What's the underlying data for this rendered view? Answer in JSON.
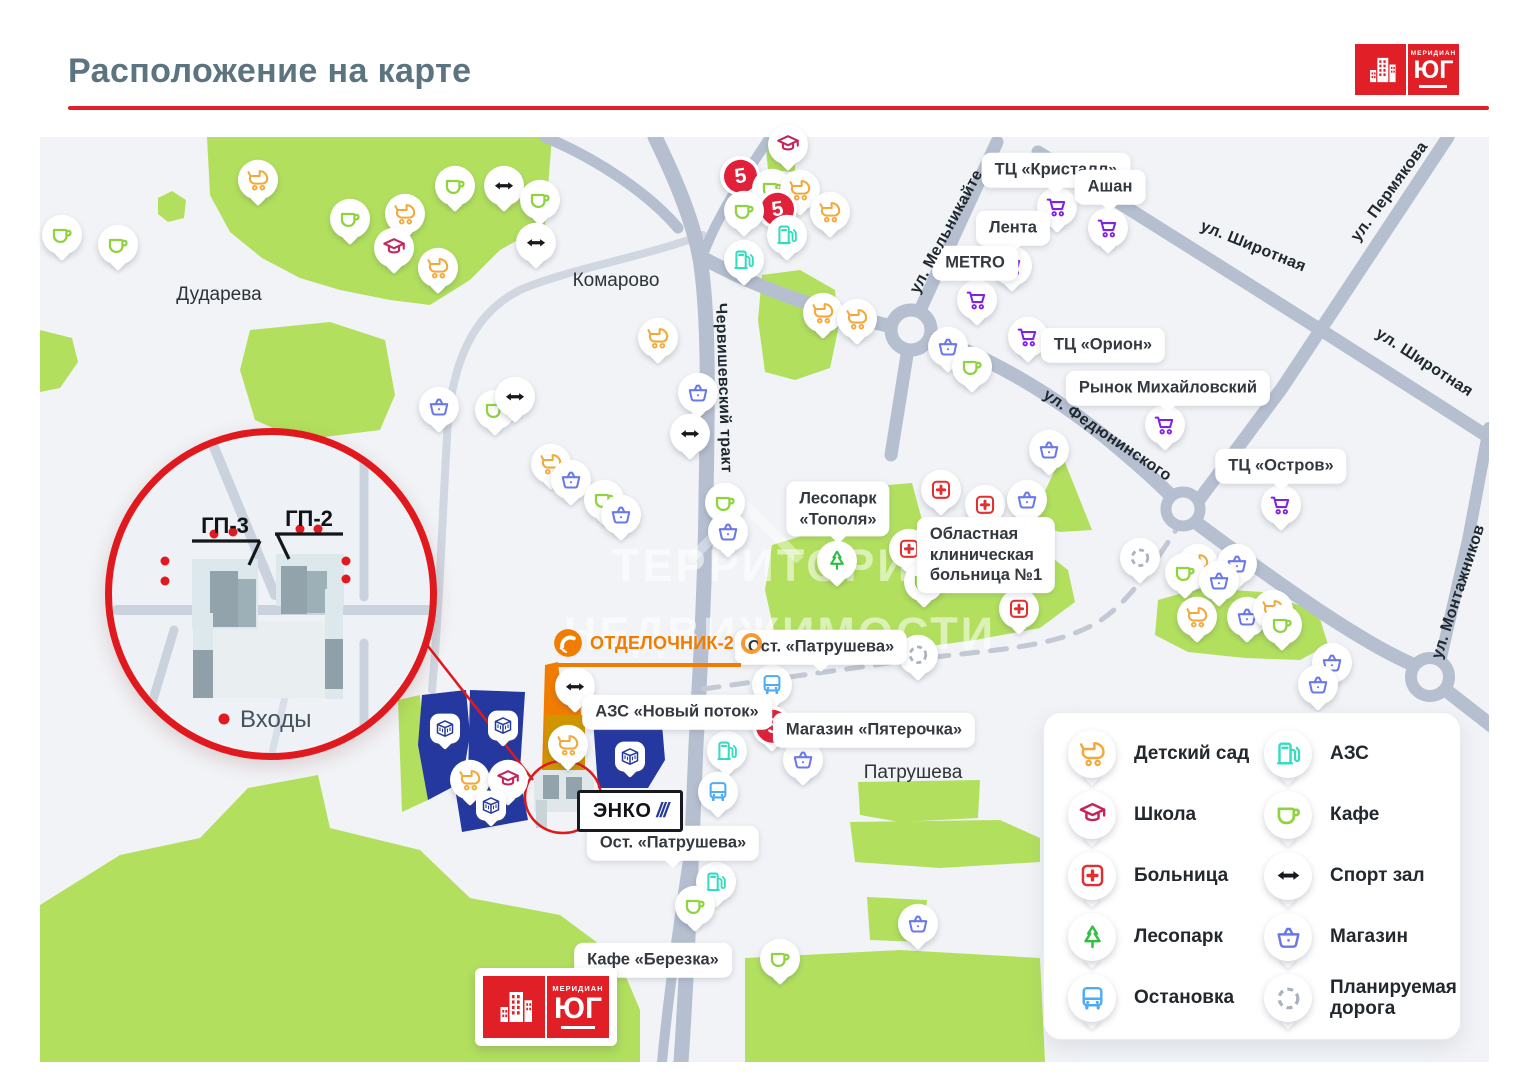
{
  "header": {
    "title": "Расположение на карте",
    "logo": {
      "top": "МЕРИДИАН",
      "main": "ЮГ"
    }
  },
  "watermark": {
    "line1": "ТЕРРИТОРИЯ",
    "line2": "НЕДВИЖИМОСТИ"
  },
  "colors": {
    "accent_red": "#e01f26",
    "map_bg": "#f1f3f6",
    "road": "#b5bfd0",
    "park": "#b2e05e",
    "complex_blue": "#2438a0",
    "otdelochnik_orange": "#f07c00",
    "icons": {
      "stroller": "#f2a93b",
      "school": "#c2255c",
      "hospital": "#e03131",
      "tree": "#2fbf43",
      "bus": "#4dabf7",
      "gas": "#35dcc0",
      "cafe": "#8fd43f",
      "sport": "#17191c",
      "basket": "#6a79e8",
      "cart": "#8123e0",
      "planned": "#a9b2bd",
      "p5": "#e2203a",
      "building": "#2438a0"
    }
  },
  "map": {
    "p5_text": "5",
    "area_labels": [
      {
        "text": "Дударева",
        "x": 219,
        "y": 295
      },
      {
        "text": "Комарово",
        "x": 616,
        "y": 281
      },
      {
        "text": "Патрушева",
        "x": 913,
        "y": 773
      }
    ],
    "street_labels": [
      {
        "text": "Червишевский тракт",
        "x": 723,
        "y": 388,
        "angle": 88
      },
      {
        "text": "ул. Мельникайте",
        "x": 947,
        "y": 232,
        "angle": -62
      },
      {
        "text": "ул. Широтная",
        "x": 1253,
        "y": 247,
        "angle": 22
      },
      {
        "text": "ул. Пермякова",
        "x": 1390,
        "y": 192,
        "angle": -54
      },
      {
        "text": "ул. Широтная",
        "x": 1424,
        "y": 363,
        "angle": 33
      },
      {
        "text": "ул. Федюнинского",
        "x": 1107,
        "y": 436,
        "angle": 34
      },
      {
        "text": "ул. Монтажников",
        "x": 1459,
        "y": 592,
        "angle": -72
      }
    ],
    "place_labels": [
      {
        "lines": [
          "ТЦ «Кристалл»"
        ],
        "x": 1056,
        "y": 170,
        "tail": true
      },
      {
        "lines": [
          "Ашан"
        ],
        "x": 1110,
        "y": 187,
        "tail": true
      },
      {
        "lines": [
          "Лента"
        ],
        "x": 1013,
        "y": 228,
        "tail": true
      },
      {
        "lines": [
          "METRO"
        ],
        "x": 975,
        "y": 263,
        "tail": false
      },
      {
        "lines": [
          "ТЦ «Орион»"
        ],
        "x": 1103,
        "y": 345,
        "tail": false
      },
      {
        "lines": [
          "Рынок Михайловский"
        ],
        "x": 1168,
        "y": 388,
        "tail": true
      },
      {
        "lines": [
          "ТЦ «Остров»"
        ],
        "x": 1281,
        "y": 466,
        "tail": true
      },
      {
        "lines": [
          "Лесопарк",
          "«Тополя»"
        ],
        "x": 838,
        "y": 509,
        "tail": true
      },
      {
        "lines": [
          "Областная",
          "клиническая",
          "больница №1"
        ],
        "x": 986,
        "y": 555,
        "tail": false,
        "align": "left"
      },
      {
        "lines": [
          "Ост. «Патрушева»"
        ],
        "x": 821,
        "y": 647,
        "tail": true
      },
      {
        "lines": [
          "Магазин «Пятерочка»"
        ],
        "x": 874,
        "y": 730,
        "tail": false
      },
      {
        "lines": [
          "АЗС «Новый поток»"
        ],
        "x": 677,
        "y": 712,
        "tail": false
      },
      {
        "lines": [
          "Ост. «Патрушева»"
        ],
        "x": 673,
        "y": 843,
        "tail": true
      },
      {
        "lines": [
          "Кафе «Березка»"
        ],
        "x": 653,
        "y": 960,
        "tail": false
      }
    ],
    "pins": [
      {
        "t": "cafe",
        "x": 62,
        "y": 238
      },
      {
        "t": "cafe",
        "x": 118,
        "y": 248
      },
      {
        "t": "stroller",
        "x": 258,
        "y": 183
      },
      {
        "t": "cafe",
        "x": 350,
        "y": 222
      },
      {
        "t": "stroller",
        "x": 405,
        "y": 217
      },
      {
        "t": "school",
        "x": 394,
        "y": 251
      },
      {
        "t": "stroller",
        "x": 438,
        "y": 271
      },
      {
        "t": "cafe",
        "x": 455,
        "y": 189
      },
      {
        "t": "sport",
        "x": 504,
        "y": 189
      },
      {
        "t": "cafe",
        "x": 540,
        "y": 203
      },
      {
        "t": "sport",
        "x": 536,
        "y": 246
      },
      {
        "t": "basket",
        "x": 439,
        "y": 410
      },
      {
        "t": "cafe",
        "x": 495,
        "y": 413
      },
      {
        "t": "sport",
        "x": 515,
        "y": 400
      },
      {
        "t": "stroller",
        "x": 551,
        "y": 467
      },
      {
        "t": "basket",
        "x": 571,
        "y": 483
      },
      {
        "t": "cafe",
        "x": 604,
        "y": 503
      },
      {
        "t": "basket",
        "x": 621,
        "y": 518
      },
      {
        "t": "stroller",
        "x": 658,
        "y": 341
      },
      {
        "t": "school",
        "x": 788,
        "y": 148
      },
      {
        "t": "p5",
        "x": 740,
        "y": 179
      },
      {
        "t": "cafe",
        "x": 772,
        "y": 192
      },
      {
        "t": "stroller",
        "x": 800,
        "y": 193
      },
      {
        "t": "p5",
        "x": 777,
        "y": 212
      },
      {
        "t": "cafe",
        "x": 744,
        "y": 214
      },
      {
        "t": "gas",
        "x": 787,
        "y": 238
      },
      {
        "t": "gas",
        "x": 744,
        "y": 263
      },
      {
        "t": "stroller",
        "x": 830,
        "y": 215
      },
      {
        "t": "stroller",
        "x": 823,
        "y": 316
      },
      {
        "t": "stroller",
        "x": 857,
        "y": 322
      },
      {
        "t": "cart",
        "x": 1057,
        "y": 210
      },
      {
        "t": "cart",
        "x": 1108,
        "y": 231
      },
      {
        "t": "cart",
        "x": 1012,
        "y": 269
      },
      {
        "t": "cart",
        "x": 977,
        "y": 303
      },
      {
        "t": "cart",
        "x": 1028,
        "y": 340
      },
      {
        "t": "basket",
        "x": 948,
        "y": 350
      },
      {
        "t": "cafe",
        "x": 972,
        "y": 370
      },
      {
        "t": "cart",
        "x": 1165,
        "y": 428
      },
      {
        "t": "basket",
        "x": 698,
        "y": 396
      },
      {
        "t": "sport",
        "x": 690,
        "y": 437
      },
      {
        "t": "cafe",
        "x": 725,
        "y": 506
      },
      {
        "t": "basket",
        "x": 728,
        "y": 535
      },
      {
        "t": "hospital",
        "x": 941,
        "y": 493
      },
      {
        "t": "hospital",
        "x": 985,
        "y": 508
      },
      {
        "t": "hospital",
        "x": 909,
        "y": 552
      },
      {
        "t": "hospital",
        "x": 1019,
        "y": 612
      },
      {
        "t": "tree",
        "x": 837,
        "y": 564
      },
      {
        "t": "cafe",
        "x": 924,
        "y": 585
      },
      {
        "t": "basket",
        "x": 1049,
        "y": 453
      },
      {
        "t": "basket",
        "x": 1027,
        "y": 503
      },
      {
        "t": "planned",
        "x": 918,
        "y": 658
      },
      {
        "t": "bus",
        "x": 772,
        "y": 688
      },
      {
        "t": "p5",
        "x": 772,
        "y": 729
      },
      {
        "t": "basket",
        "x": 803,
        "y": 763
      },
      {
        "t": "cart",
        "x": 1281,
        "y": 508
      },
      {
        "t": "planned",
        "x": 1140,
        "y": 561
      },
      {
        "t": "stroller",
        "x": 1198,
        "y": 567
      },
      {
        "t": "cafe",
        "x": 1185,
        "y": 576
      },
      {
        "t": "basket",
        "x": 1237,
        "y": 567
      },
      {
        "t": "basket",
        "x": 1219,
        "y": 584
      },
      {
        "t": "stroller",
        "x": 1197,
        "y": 620
      },
      {
        "t": "basket",
        "x": 1247,
        "y": 620
      },
      {
        "t": "stroller",
        "x": 1273,
        "y": 613
      },
      {
        "t": "cafe",
        "x": 1282,
        "y": 628
      },
      {
        "t": "basket",
        "x": 1332,
        "y": 666
      },
      {
        "t": "basket",
        "x": 1318,
        "y": 688
      },
      {
        "t": "sport",
        "x": 575,
        "y": 690
      },
      {
        "t": "stroller",
        "x": 568,
        "y": 748
      },
      {
        "t": "stroller",
        "x": 470,
        "y": 783
      },
      {
        "t": "school",
        "x": 508,
        "y": 783
      },
      {
        "t": "gas",
        "x": 727,
        "y": 754
      },
      {
        "t": "bus",
        "x": 718,
        "y": 795
      },
      {
        "t": "gas",
        "x": 716,
        "y": 885
      },
      {
        "t": "cafe",
        "x": 695,
        "y": 909
      },
      {
        "t": "cafe",
        "x": 780,
        "y": 962
      },
      {
        "t": "basket",
        "x": 918,
        "y": 927
      }
    ],
    "building_markers": [
      {
        "x": 445,
        "y": 731
      },
      {
        "x": 503,
        "y": 728
      },
      {
        "x": 491,
        "y": 808
      },
      {
        "x": 630,
        "y": 759
      }
    ],
    "logos": {
      "otdelochnik": "ОТДЕЛОЧНИК-2",
      "enko": "ЭНКО",
      "enko_slashes": "///"
    }
  },
  "inset": {
    "gp3": "ГП-3",
    "gp2": "ГП-2",
    "entrances": "Входы"
  },
  "legend": {
    "items": [
      {
        "icon": "stroller",
        "label": "Детский сад"
      },
      {
        "icon": "school",
        "label": "Школа"
      },
      {
        "icon": "hospital",
        "label": "Больница"
      },
      {
        "icon": "tree",
        "label": "Лесопарк"
      },
      {
        "icon": "bus",
        "label": "Остановка"
      },
      {
        "icon": "gas",
        "label": "АЗС"
      },
      {
        "icon": "cafe",
        "label": "Кафе"
      },
      {
        "icon": "sport",
        "label": "Спорт зал"
      },
      {
        "icon": "basket",
        "label": "Магазин"
      },
      {
        "icon": "planned",
        "label": "Планируемая дорога"
      }
    ]
  }
}
